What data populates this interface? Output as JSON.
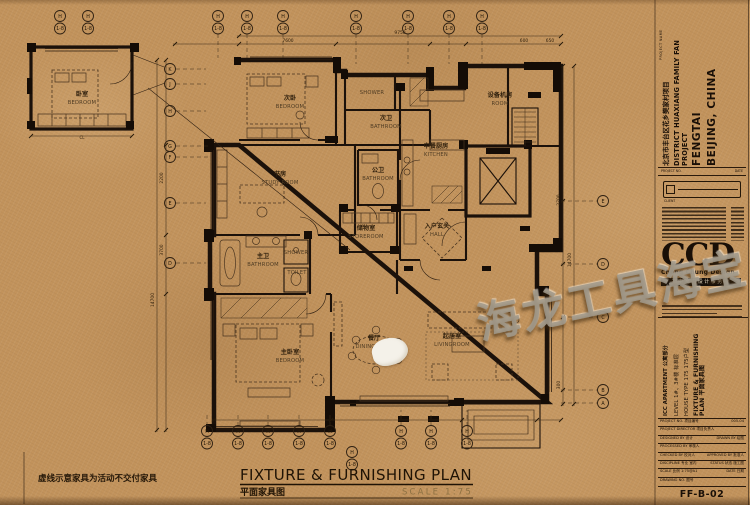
{
  "sheet": {
    "note": "虚线示意家具为活动不交付家具",
    "title": {
      "en": "FIXTURE & FURNISHING PLAN",
      "zh": "平面家具图",
      "scale": "SCALE 1:75"
    },
    "watermark": "海龙工具海宝",
    "centerline_label": "CL"
  },
  "rooms": {
    "detached_bedroom": {
      "zh": "卧室",
      "en": "BEDROOM"
    },
    "secondary_bedroom": {
      "zh": "次卧",
      "en": "BEDROOM"
    },
    "shower_room": {
      "en": "SHOWER"
    },
    "secondary_bathroom": {
      "zh": "次卫",
      "en": "BATHROOM"
    },
    "study": {
      "zh": "书房",
      "en": "STUDY ROOM"
    },
    "guest_bathroom": {
      "zh": "公卫",
      "en": "BATHROOM"
    },
    "kitchen": {
      "zh": "中餐厨房",
      "en": "KITCHEN"
    },
    "storage": {
      "zh": "储物室",
      "en": "STOREROOM"
    },
    "hall": {
      "zh": "入户玄关",
      "en": "HALL"
    },
    "master_bathroom": {
      "zh": "主卫",
      "en": "BATHROOM"
    },
    "master_shower": {
      "en": "SHOWER"
    },
    "toilet": {
      "en": "TOILET"
    },
    "master_bedroom": {
      "zh": "主卧室",
      "en": "BEDROOM"
    },
    "dining": {
      "zh": "餐厅",
      "en": "DININGROOM"
    },
    "living": {
      "zh": "起居室",
      "en": "LIVINGROOM"
    },
    "equipment": {
      "zh": "设备机房",
      "en": "ROOM"
    }
  },
  "grid": {
    "pair_top": "H",
    "pair_bottom": "1-8",
    "left": [
      "K",
      "J",
      "H",
      "G",
      "F",
      "E",
      "D"
    ],
    "right": [
      "E",
      "D",
      "C",
      "B",
      "A"
    ]
  },
  "dims": {
    "d7600": "7600",
    "d9750": "9750",
    "d600": "600",
    "d650": "650",
    "d2200": "2200",
    "d3700": "3700",
    "d14700": "14700",
    "d2700": "2700",
    "d14700b": "14700",
    "d300": "300"
  },
  "title_block": {
    "project_name_label": "PROJECT NAME",
    "project_zh": "北京市丰台区花乡樊家村项目",
    "project_en": "DISTRICT HUAXIANG FAMILY FAN PROJECT",
    "project_city": "FENGTAI",
    "project_country": "BEIJING, CHINA",
    "project_no_label": "PROJECT NO.",
    "date_label": "DATE",
    "client_label": "CLIENT",
    "logo": {
      "name": "CCD",
      "sub": "Cheng Chung Design",
      "zh": "郑中室内设计事务所"
    },
    "info": {
      "l1": "ICC APARTMENT 公寓部分",
      "l2": "LEVEL 1#、3#楼 标准层",
      "l3": "HOUSE TYPE 175 175户型",
      "l4": "FIXTURE & FURNISHING PLAN 平面家具图"
    },
    "table": [
      {
        "l": "PROJECT NO. 项目编号",
        "r": "005-04"
      },
      {
        "l": "PROJECT DIRECTOR 项目负责人",
        "r": ""
      },
      {
        "l": "DESIGNED BY 设计",
        "r": "DRAWN BY 绘图"
      },
      {
        "l": "PROCESSED BY 审核人",
        "r": ""
      },
      {
        "l": "CHECKED BY 校对人",
        "r": "APPROVED BY 批准人"
      },
      {
        "l": "DISCIPLINE 专业 室内",
        "r": "STATUS 状态 施工图"
      },
      {
        "l": "SCALE 比例 1:75@A1",
        "r": "DATE 日期"
      },
      {
        "l": "DRAWING NO. 图号",
        "r": ""
      }
    ],
    "drawing_no": "FF-B-02"
  }
}
